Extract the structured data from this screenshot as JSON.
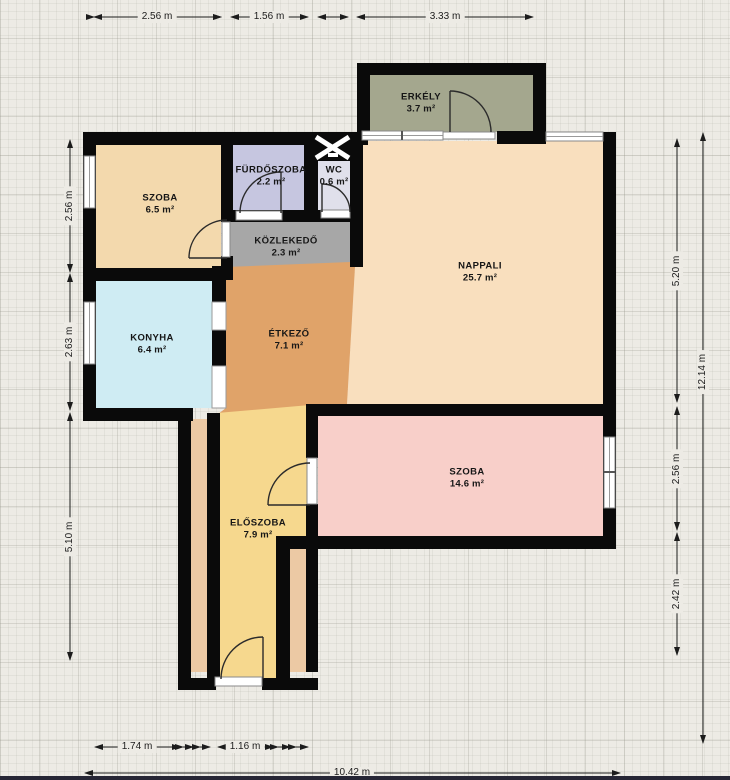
{
  "plan": {
    "rooms": [
      {
        "id": "szoba-1",
        "name": "SZOBA",
        "area": "6.5 m²",
        "color": "#f3d9ad"
      },
      {
        "id": "furdoszoba",
        "name": "FÜRDŐSZOBA",
        "area": "2.2 m²",
        "color": "#c6c6e0"
      },
      {
        "id": "wc",
        "name": "WC",
        "area": "0.6 m²",
        "color": "#e0e0eb"
      },
      {
        "id": "erkely",
        "name": "ERKÉLY",
        "area": "3.7 m²",
        "color": "#a4a78e"
      },
      {
        "id": "kozlekedo",
        "name": "KÖZLEKEDŐ",
        "area": "2.3 m²",
        "color": "#a7a7a7"
      },
      {
        "id": "nappali",
        "name": "NAPPALI",
        "area": "25.7 m²",
        "color": "#f9dfbe"
      },
      {
        "id": "konyha",
        "name": "KONYHA",
        "area": "6.4 m²",
        "color": "#cfecf3"
      },
      {
        "id": "etkezo",
        "name": "ÉTKEZŐ",
        "area": "7.1 m²",
        "color": "#e0a369"
      },
      {
        "id": "eloszoba",
        "name": "ELŐSZOBA",
        "area": "7.9 m²",
        "color": "#f6d88e"
      },
      {
        "id": "szoba-2",
        "name": "SZOBA",
        "area": "14.6 m²",
        "color": "#f8cfc9"
      }
    ],
    "dimensions": {
      "top": [
        "2.56 m",
        "1.56 m",
        "3.33 m"
      ],
      "left": [
        "2.56 m",
        "2.63 m",
        "5.10 m"
      ],
      "right": [
        "5.20 m",
        "2.56 m",
        "2.42 m"
      ],
      "right_total": "12.14 m",
      "bottom": [
        "1.74 m",
        "1.16 m"
      ],
      "bottom_total": "10.42 m"
    },
    "colors": {
      "page": "#edebe5",
      "wall": "#0a0a0a",
      "dim": "#1c1c1c",
      "cavity": "#ecc9a4",
      "bottom_bar": "#262635"
    }
  }
}
